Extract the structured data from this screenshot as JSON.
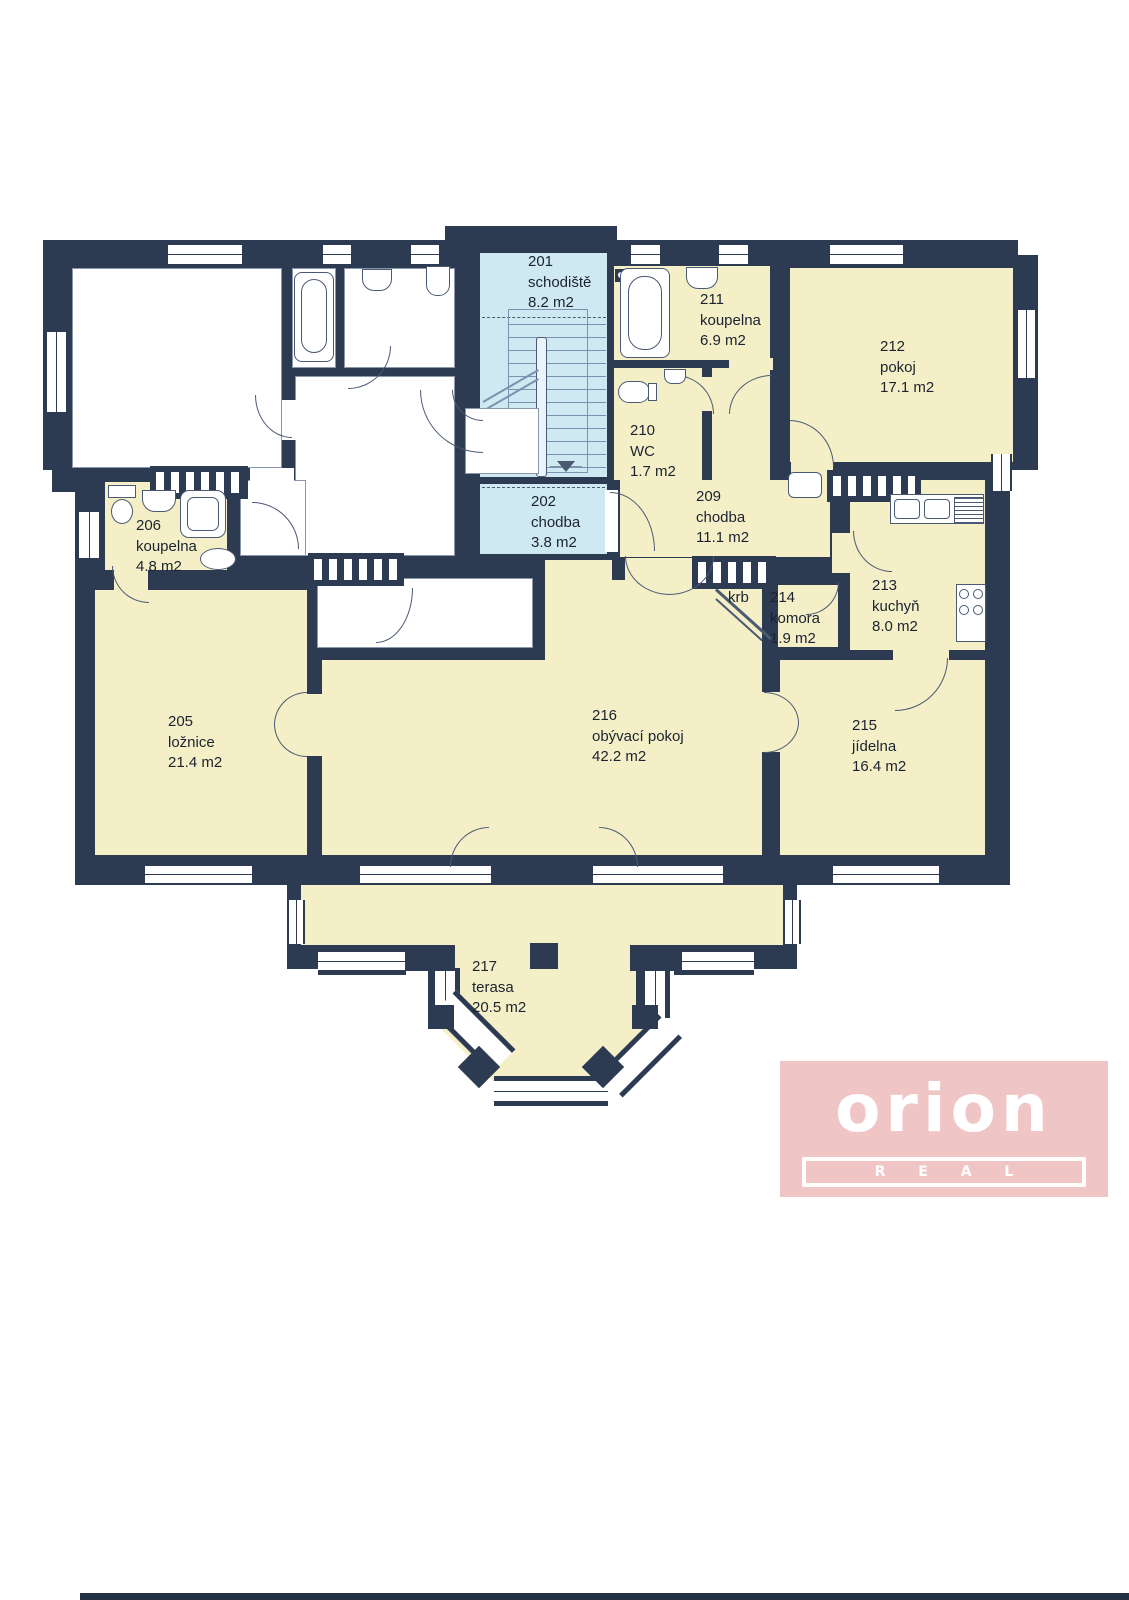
{
  "plan": {
    "floor": "2nd floor apartment floor plan",
    "rooms": [
      {
        "id": "201",
        "name": "schodiště",
        "area": "8.2 m2"
      },
      {
        "id": "202",
        "name": "chodba",
        "area": "3.8 m2"
      },
      {
        "id": "205",
        "name": "ložnice",
        "area": "21.4 m2"
      },
      {
        "id": "206",
        "name": "koupelna",
        "area": "4.8 m2"
      },
      {
        "id": "209",
        "name": "chodba",
        "area": "11.1 m2"
      },
      {
        "id": "210",
        "name": "WC",
        "area": "1.7 m2"
      },
      {
        "id": "211",
        "name": "koupelna",
        "area": "6.9 m2"
      },
      {
        "id": "212",
        "name": "pokoj",
        "area": "17.1 m2"
      },
      {
        "id": "213",
        "name": "kuchyň",
        "area": "8.0 m2"
      },
      {
        "id": "214",
        "name": "komora",
        "area": "1.9 m2"
      },
      {
        "id": "215",
        "name": "jídelna",
        "area": "16.4 m2"
      },
      {
        "id": "216",
        "name": "obývací pokoj",
        "area": "42.2 m2"
      },
      {
        "id": "217",
        "name": "terasa",
        "area": "20.5 m2"
      }
    ],
    "annotations": {
      "fireplace": "krb"
    }
  },
  "logo": {
    "brand": "orion",
    "sub": "R E A L"
  },
  "colors": {
    "wall": "#2c3a52",
    "room_yellow": "#f4efc6",
    "stair_blue": "#cfe9f3",
    "white_room": "#ffffff",
    "logo_pink": "#f0c5c5",
    "line": "#4a5a74"
  }
}
